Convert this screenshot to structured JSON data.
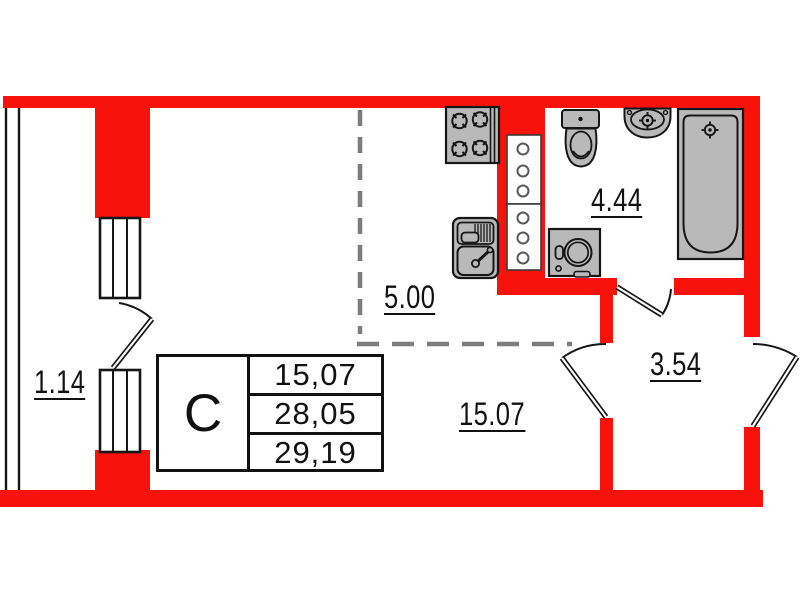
{
  "plan": {
    "title": "studio-apartment-floor-plan",
    "colors": {
      "wall_color": "#f8120b",
      "fixture_fill": "#b9b9b9",
      "fixture_stroke": "#161616",
      "dash_color": "#7d7d7d",
      "line_color": "#111111"
    },
    "rooms": {
      "balcony": {
        "area": "1.14"
      },
      "kitchen": {
        "area": "5.00"
      },
      "bathroom": {
        "area": "4.44"
      },
      "living_room": {
        "area": "15.07"
      },
      "hallway": {
        "area": "3.54"
      }
    },
    "info_table": {
      "type_label": "С",
      "rows": [
        "15,07",
        "28,05",
        "29,19"
      ]
    },
    "fixtures": [
      "stove-icon",
      "kitchen-sink-icon",
      "vent-shaft",
      "toilet-icon",
      "washbasin-icon",
      "bathtub-icon",
      "washing-machine-icon"
    ]
  }
}
